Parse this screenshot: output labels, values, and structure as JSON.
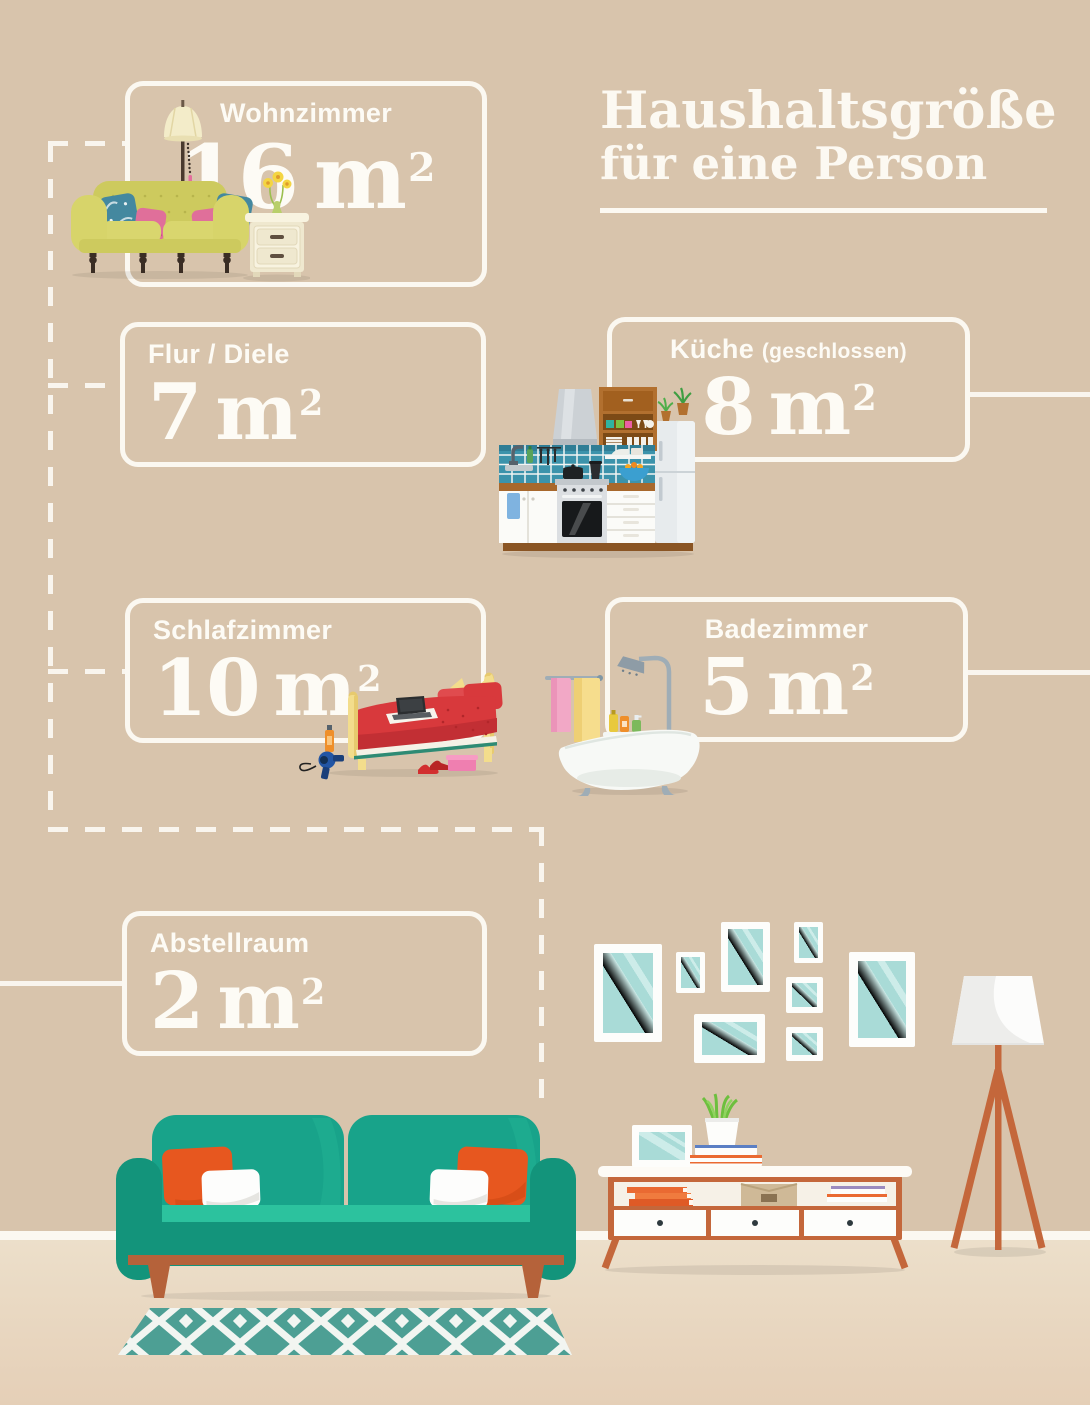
{
  "title": {
    "line1": "Haushaltsgröße",
    "line2": "für eine Person"
  },
  "rooms": [
    {
      "id": "wohnzimmer",
      "label": "Wohnzimmer",
      "area_value": "16",
      "area_unit": "m",
      "area_exponent": "2",
      "area_m2": 16
    },
    {
      "id": "flur-diele",
      "label": "Flur / Diele",
      "area_value": "7",
      "area_unit": "m",
      "area_exponent": "2",
      "area_m2": 7
    },
    {
      "id": "kueche",
      "label": "Küche",
      "qualifier": "(geschlossen)",
      "area_value": "8",
      "area_unit": "m",
      "area_exponent": "2",
      "area_m2": 8
    },
    {
      "id": "schlafzimmer",
      "label": "Schlafzimmer",
      "area_value": "10",
      "area_unit": "m",
      "area_exponent": "2",
      "area_m2": 10
    },
    {
      "id": "badezimmer",
      "label": "Badezimmer",
      "area_value": "5",
      "area_unit": "m",
      "area_exponent": "2",
      "area_m2": 5
    },
    {
      "id": "abstellraum",
      "label": "Abstellraum",
      "area_value": "2",
      "area_unit": "m",
      "area_exponent": "2",
      "area_m2": 2
    }
  ],
  "illustrations": [
    "living-room-sofa",
    "kitchen",
    "bed",
    "bathtub",
    "gallery-frames",
    "floor-lamp",
    "sideboard",
    "teal-sofa",
    "rug"
  ],
  "colors": {
    "wall": "#d8c4ac",
    "floor": "#e9dac5",
    "line_white": "#f9f5ee",
    "text_white": "#fdfbf5",
    "teal_sofa": "#18a38a",
    "terracotta": "#c4673b",
    "rug_teal": "#4d9f94",
    "frame_glass": "#a9dbd7",
    "pillow_orange": "#e7571f",
    "olive_sofa": "#cdca5e",
    "bed_red": "#d8393c",
    "tile_blue": "#3c93ab",
    "cabinet_brown": "#b2702f"
  }
}
